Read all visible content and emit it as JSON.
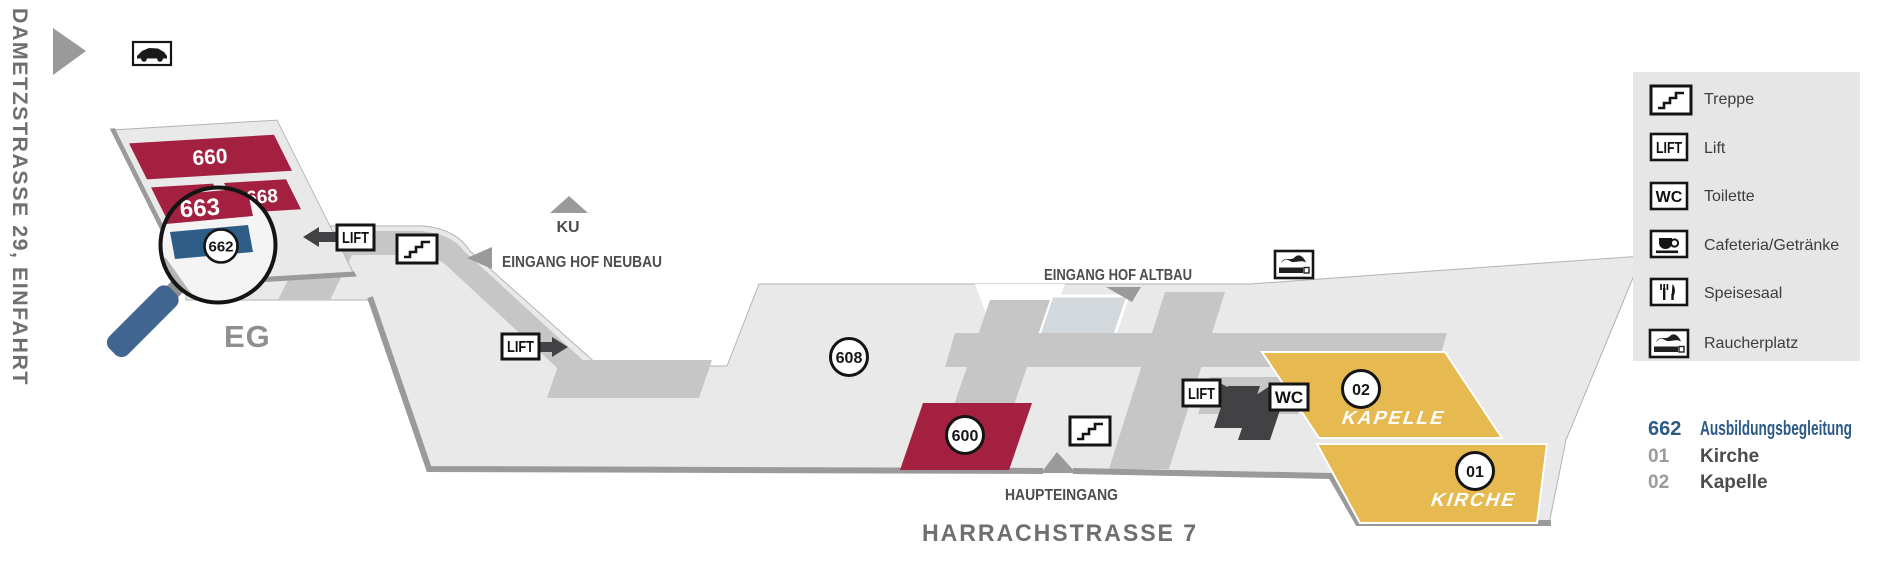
{
  "map": {
    "streets": {
      "left_vertical": "DAMETZSTRASSE 29, EINFAHRT",
      "bottom": "HARRACHSTRASSE 7"
    },
    "floor_label": "EG",
    "entrances": {
      "ku": "KU",
      "hof_neubau": "EINGANG HOF NEUBAU",
      "hof_altbau": "EINGANG HOF ALTBAU",
      "haupteingang": "HAUPTEINGANG"
    },
    "lift_label": "LIFT",
    "wc_label": "WC",
    "rooms": {
      "r660": "660",
      "r663": "663",
      "r668": "668",
      "r662": "662",
      "r600": "600",
      "r608": "608"
    },
    "areas": {
      "kapelle": {
        "number": "02",
        "label": "KAPELLE"
      },
      "kirche": {
        "number": "01",
        "label": "KIRCHE"
      }
    }
  },
  "legend": {
    "items": [
      {
        "icon": "stairs-icon",
        "label": "Treppe"
      },
      {
        "icon": "lift-icon",
        "label": "Lift"
      },
      {
        "icon": "wc-icon",
        "label": "Toilette"
      },
      {
        "icon": "cafeteria-icon",
        "label": "Cafeteria/Getränke"
      },
      {
        "icon": "cutlery-icon",
        "label": "Speisesaal"
      },
      {
        "icon": "smoking-icon",
        "label": "Raucherplatz"
      }
    ]
  },
  "index": {
    "rows": [
      {
        "number": "662",
        "label": "Ausbildungsbegleitung"
      },
      {
        "number": "01",
        "label": "Kirche"
      },
      {
        "number": "02",
        "label": "Kapelle"
      }
    ]
  },
  "colors": {
    "room_red": "#a32041",
    "room_blue": "#2e5d88",
    "gold": "#e6ba50",
    "building": "#e9e9e9",
    "corridor": "#c6c6c6",
    "wall": "#9a9a9a",
    "index_blue": "#2c5a87",
    "legend_bg": "#e6e6e6",
    "dark": "#3e3e40",
    "handle_blue": "#3f6590"
  }
}
